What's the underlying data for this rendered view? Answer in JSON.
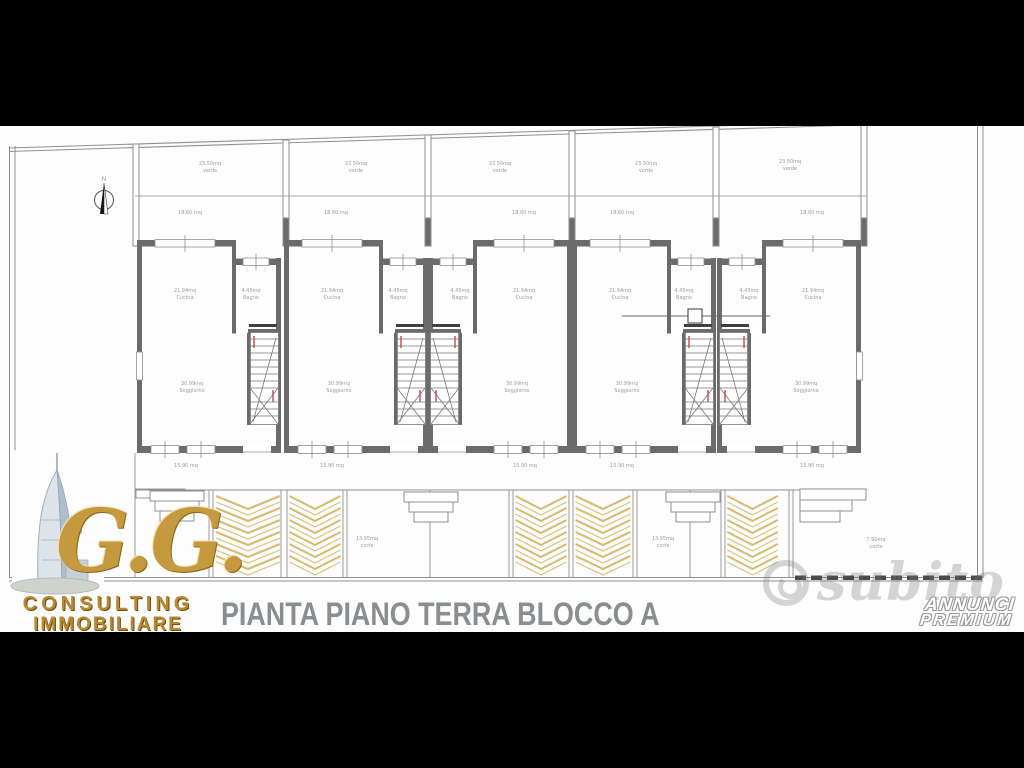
{
  "caption": "PIANTA PIANO TERRA BLOCCO A",
  "branding": {
    "initials": "G.G.",
    "line1": "CONSULTING",
    "line2": "IMMOBILIARE",
    "logo_icon": "burj-al-arab-tower",
    "gold_color": "#c59a3e"
  },
  "watermark": {
    "name": "subito"
  },
  "badge": {
    "line1": "ANNUNCI",
    "line2": "PREMIUM"
  },
  "plan": {
    "north": "N",
    "labels": {
      "garden_area": "23.50mq",
      "garden_name": "verde",
      "front": "18.60 mq",
      "terrace": "15.90 mq",
      "kitchen_area": "21.94mq",
      "kitchen_name": "Cucina",
      "bath_area": "4.45mq",
      "bath_name": "Bagno",
      "living_area": "30.99mq",
      "living_name": "Soggiorno",
      "court_area": "13.95mq",
      "court_name": "corte",
      "court_small_area": "7.90mq",
      "court_small_name": "corte",
      "side_area": "13.95mq",
      "side_name": "verde"
    },
    "colors": {
      "wall": "#6b6b6b",
      "thin_line": "#8f8f8f",
      "chevron": "#d8bc72",
      "stair_mark": "#c23a3a",
      "label_text": "#9a9da0"
    }
  }
}
